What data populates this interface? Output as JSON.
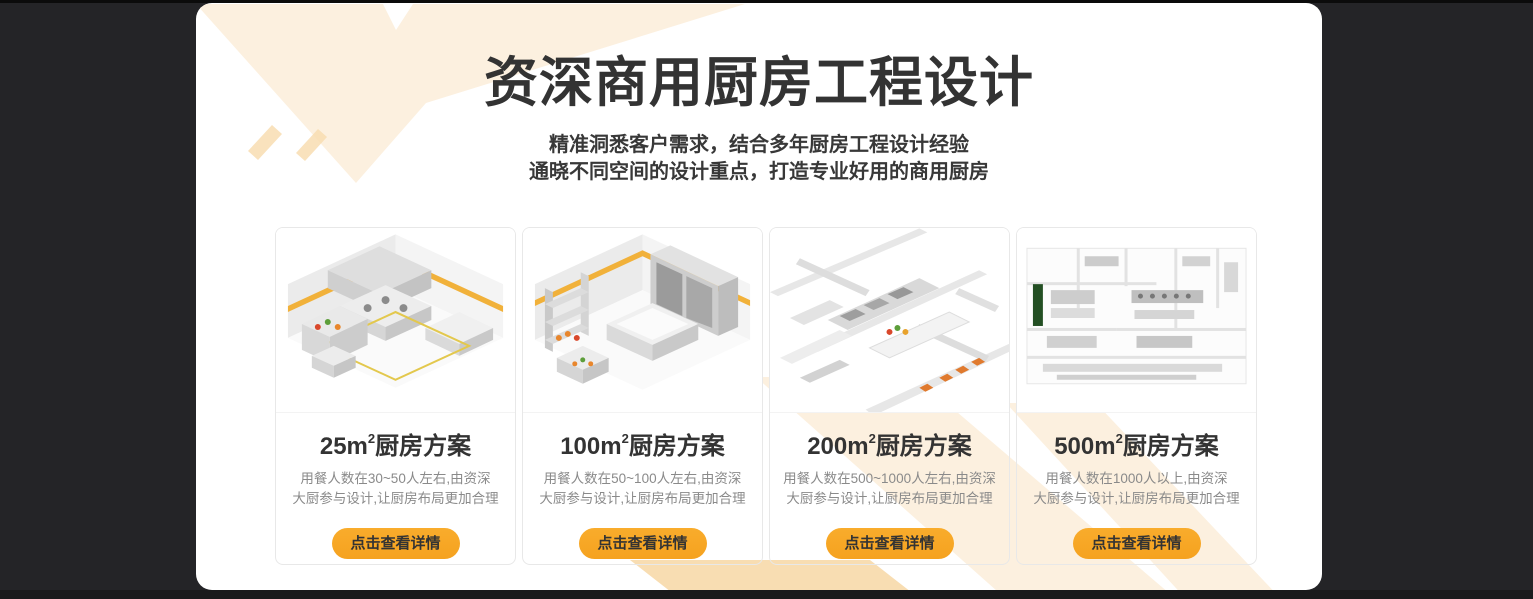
{
  "page": {
    "width": 1533,
    "height": 599
  },
  "colors": {
    "page_background": "#242427",
    "panel_background": "#ffffff",
    "chevron_cream": "#FCF0DF",
    "chevron_tan": "#F8DDB2",
    "accent_orange": "#F7A826",
    "heading_text": "#333333",
    "description_text": "#8A8A8A",
    "card_border": "#E8E8E8"
  },
  "header": {
    "title": "资深商用厨房工程设计",
    "subtitle_line1": "精准洞悉客户需求，结合多年厨房工程设计经验",
    "subtitle_line2": "通晓不同空间的设计重点，打造专业好用的商用厨房"
  },
  "cards": [
    {
      "id": "25sqm",
      "title_area": "25m",
      "title_sup": "2",
      "title_suffix": "厨房方案",
      "desc_line1": "用餐人数在30~50人左右,由资深",
      "desc_line2": "大厨参与设计,让厨房布局更加合理",
      "button_label": "点击查看详情",
      "image_name": "isometric-kitchen-render-25sqm"
    },
    {
      "id": "100sqm",
      "title_area": "100m",
      "title_sup": "2",
      "title_suffix": "厨房方案",
      "desc_line1": "用餐人数在50~100人左右,由资深",
      "desc_line2": "大厨参与设计,让厨房布局更加合理",
      "button_label": "点击查看详情",
      "image_name": "isometric-kitchen-render-100sqm"
    },
    {
      "id": "200sqm",
      "title_area": "200m",
      "title_sup": "2",
      "title_suffix": "厨房方案",
      "desc_line1": "用餐人数在500~1000人左右,由资深",
      "desc_line2": "大厨参与设计,让厨房布局更加合理",
      "button_label": "点击查看详情",
      "image_name": "isometric-kitchen-render-200sqm"
    },
    {
      "id": "500sqm",
      "title_area": "500m",
      "title_sup": "2",
      "title_suffix": "厨房方案",
      "desc_line1": "用餐人数在1000人以上,由资深",
      "desc_line2": "大厨参与设计,让厨房布局更加合理",
      "button_label": "点击查看详情",
      "image_name": "isometric-kitchen-render-500sqm"
    }
  ]
}
